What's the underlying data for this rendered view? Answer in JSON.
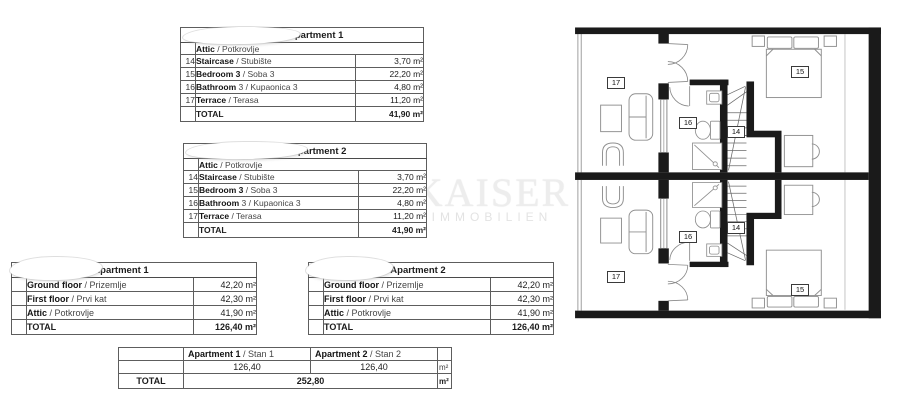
{
  "watermark": {
    "line1": "KAISER",
    "line2": "IMMOBILIEN"
  },
  "attic_tables": [
    {
      "title": "- Apartment 1",
      "section": {
        "bold": "Attic",
        "rest": "/ Potkrovlje"
      },
      "rows": [
        {
          "num": "14",
          "bold": "Staircase",
          "rest": "/ Stubište",
          "value": "3,70 m²"
        },
        {
          "num": "15",
          "bold": "Bedroom 3",
          "rest": "/ Soba 3",
          "value": "22,20 m²"
        },
        {
          "num": "16",
          "bold": "Bathroom",
          "rest": "3 / Kupaonica 3",
          "value": "4,80 m²"
        },
        {
          "num": "17",
          "bold": "Terrace",
          "rest": "/ Terasa",
          "value": "11,20 m²"
        }
      ],
      "total": {
        "label": "TOTAL",
        "value": "41,90 m²"
      }
    },
    {
      "title": "- Apartment 2",
      "section": {
        "bold": "Attic",
        "rest": "/ Potkrovlje"
      },
      "rows": [
        {
          "num": "14",
          "bold": "Staircase",
          "rest": "/ Stubište",
          "value": "3,70 m²"
        },
        {
          "num": "15",
          "bold": "Bedroom 3",
          "rest": "/ Soba 3",
          "value": "22,20 m²"
        },
        {
          "num": "16",
          "bold": "Bathroom",
          "rest": "3 / Kupaonica 3",
          "value": "4,80 m²"
        },
        {
          "num": "17",
          "bold": "Terrace",
          "rest": "/ Terasa",
          "value": "11,20 m²"
        }
      ],
      "total": {
        "label": "TOTAL",
        "value": "41,90 m²"
      }
    }
  ],
  "summary_tables": [
    {
      "title": "Apartment 1",
      "rows": [
        {
          "bold": "Ground floor",
          "rest": "/ Prizemlje",
          "value": "42,20 m²"
        },
        {
          "bold": "First floor",
          "rest": "/ Prvi kat",
          "value": "42,30 m²"
        },
        {
          "bold": "Attic",
          "rest": "/ Potkrovlje",
          "value": "41,90 m²"
        }
      ],
      "total": {
        "label": "TOTAL",
        "value": "126,40 m²"
      }
    },
    {
      "title": "Apartment 2",
      "rows": [
        {
          "bold": "Ground floor",
          "rest": "/ Prizemlje",
          "value": "42,20 m²"
        },
        {
          "bold": "First floor",
          "rest": "/ Prvi kat",
          "value": "42,30 m²"
        },
        {
          "bold": "Attic",
          "rest": "/ Potkrovlje",
          "value": "41,90 m²"
        }
      ],
      "total": {
        "label": "TOTAL",
        "value": "126,40 m²"
      }
    }
  ],
  "grand_table": {
    "columns": [
      {
        "bold": "Apartment 1",
        "rest": "/ Stan 1",
        "value": "126,40"
      },
      {
        "bold": "Apartment 2",
        "rest": "/ Stan 2",
        "value": "126,40"
      }
    ],
    "unit": "m²",
    "total": {
      "label": "TOTAL",
      "value": "252,80",
      "unit": "m²"
    }
  },
  "plan": {
    "labels": {
      "top": {
        "terrace": "17",
        "bathroom": "16",
        "staircase": "14",
        "bedroom": "15"
      },
      "bottom": {
        "terrace": "17",
        "bathroom": "16",
        "staircase": "14",
        "bedroom": "15"
      }
    }
  }
}
